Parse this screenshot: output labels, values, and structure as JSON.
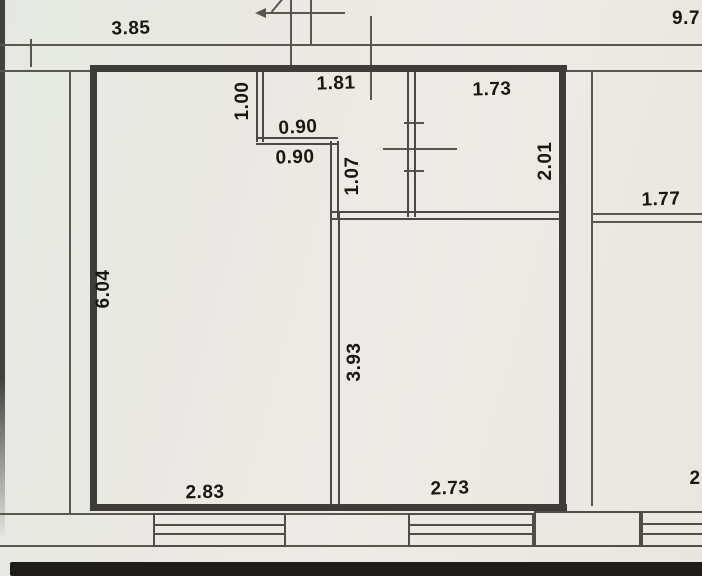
{
  "plan": {
    "type": "floor-plan-scan",
    "dimensions": [
      {
        "id": "top-left-width",
        "value": "3.85"
      },
      {
        "id": "top-right-width",
        "value": "9.7"
      },
      {
        "id": "entry-span-width",
        "value": "1.81"
      },
      {
        "id": "top-right-room-width",
        "value": "1.73"
      },
      {
        "id": "recess-depth",
        "value": "1.00"
      },
      {
        "id": "recess-width-upper",
        "value": "0.90"
      },
      {
        "id": "recess-width-lower",
        "value": "0.90"
      },
      {
        "id": "hall-partition-length",
        "value": "1.07"
      },
      {
        "id": "top-right-room-depth",
        "value": "2.01"
      },
      {
        "id": "adjacent-room-width",
        "value": "1.77"
      },
      {
        "id": "left-room-depth",
        "value": "6.04"
      },
      {
        "id": "right-room-depth",
        "value": "3.93"
      },
      {
        "id": "left-room-width",
        "value": "2.83"
      },
      {
        "id": "right-room-width",
        "value": "2.73"
      },
      {
        "id": "bottom-right-partial",
        "value": "2"
      }
    ],
    "colors": {
      "paper": "#e9e8e3",
      "thick_wall": "#3d3c39",
      "thin_line": "#59564f",
      "text": "#18160f",
      "scan_edge": "#1d1c1a"
    }
  }
}
